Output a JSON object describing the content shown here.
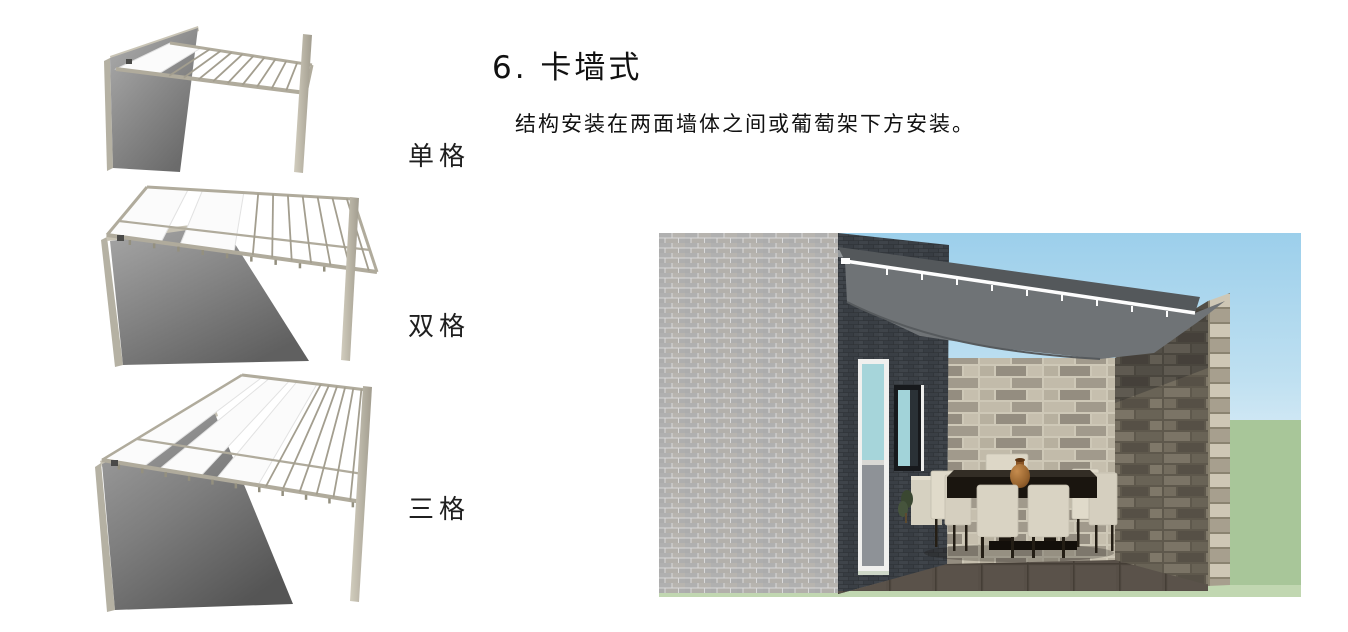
{
  "section": {
    "title": "6. 卡墙式",
    "description": "结构安装在两面墙体之间或葡萄架下方安装。"
  },
  "figures": [
    {
      "name": "single-grid",
      "label": "单格"
    },
    {
      "name": "double-grid",
      "label": "双格"
    },
    {
      "name": "triple-grid",
      "label": "三格"
    }
  ],
  "colors": {
    "canopy_gray": "#6f7376",
    "frame_beige": "#b0ab9c",
    "wall_gray": "#7d7d7d",
    "fabric_white": "#fbfbfb",
    "sky_blue": "#9ccfeb",
    "grass_green": "#a8c699",
    "stone_beige": "#cec8b7",
    "chair_cream": "#d9d3c3"
  }
}
